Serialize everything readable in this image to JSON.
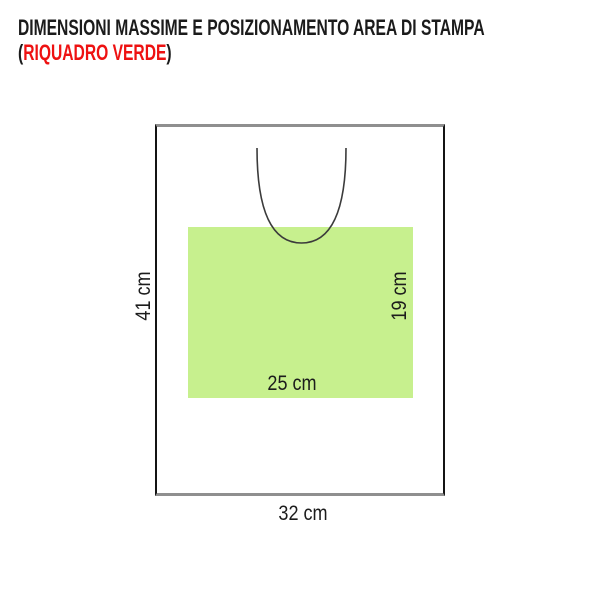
{
  "title": {
    "line1": "DIMENSIONI MASSIME E POSIZIONAMENTO AREA DI STAMPA",
    "line2_prefix": "(",
    "line2_highlight": "RIQUADRO VERDE",
    "line2_suffix": ")",
    "text_color": "#1b1b1b",
    "highlight_color": "#ee1111"
  },
  "diagram": {
    "bag": {
      "width_label": "32 cm",
      "height_label": "41 cm",
      "width_cm": 32,
      "height_cm": 41,
      "outline_side_color": "#141414",
      "outline_top_bottom_color": "#8f8f8f"
    },
    "print_area": {
      "width_label": "25 cm",
      "height_label": "19 cm",
      "width_cm": 25,
      "height_cm": 19,
      "fill_color": "#c7f08e"
    },
    "handle": {
      "shape": "u-curve-neckline",
      "stroke_color": "#3b3b3b"
    }
  }
}
